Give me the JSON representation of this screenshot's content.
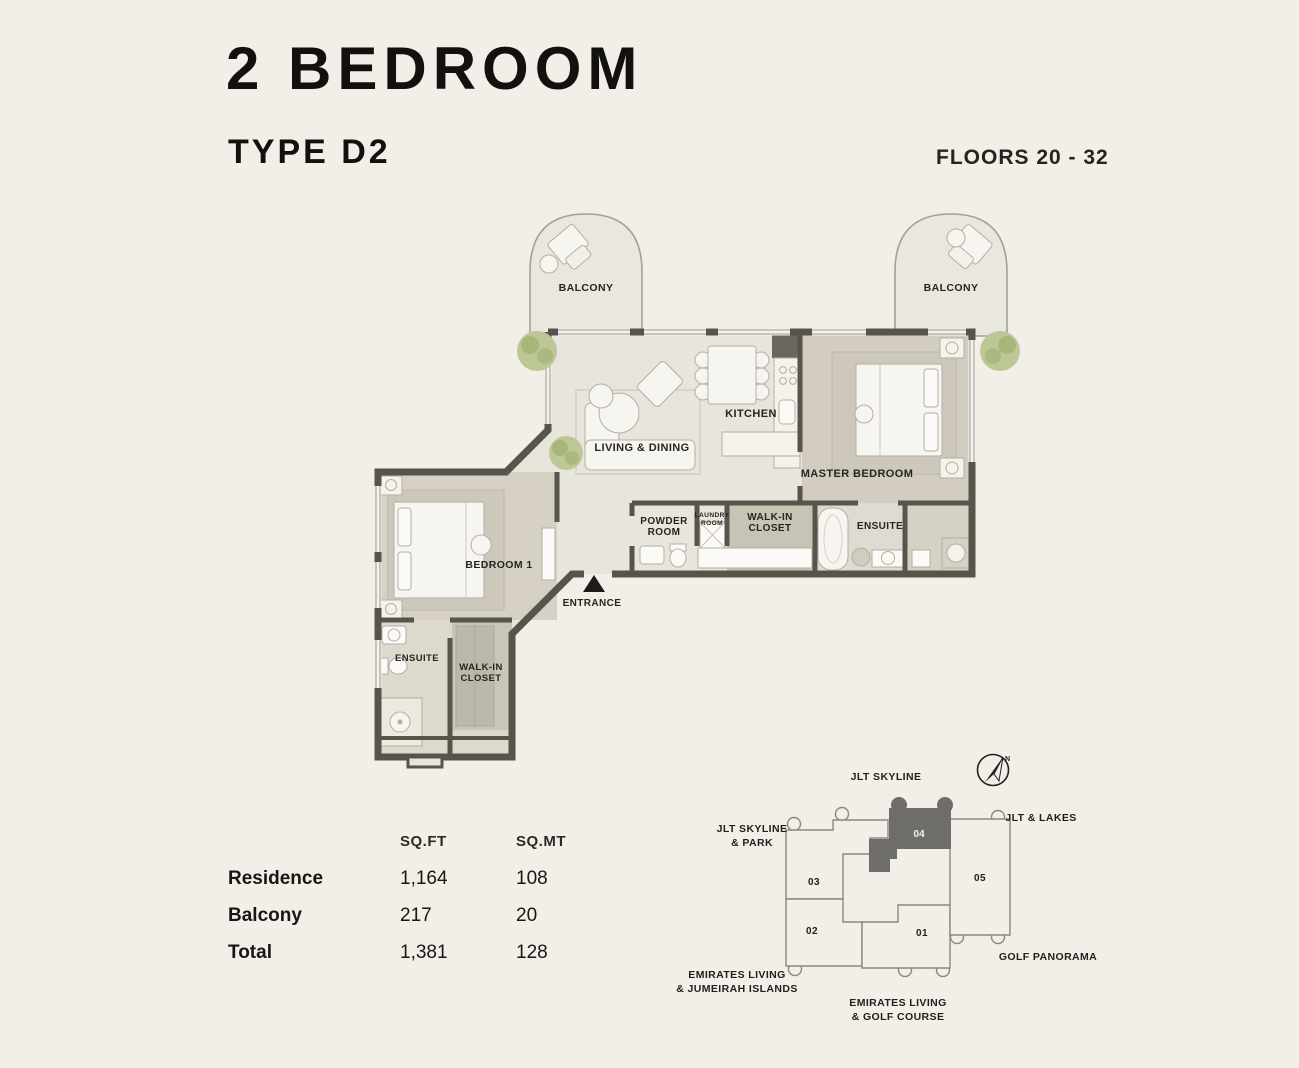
{
  "header": {
    "title": "2 BEDROOM",
    "type": "TYPE D2",
    "floors": "FLOORS 20 - 32"
  },
  "floor_plan": {
    "balcony_left": "BALCONY",
    "balcony_right": "BALCONY",
    "living_dining": "LIVING & DINING",
    "kitchen": "KITCHEN",
    "master_bedroom": "MASTER BEDROOM",
    "powder_room": {
      "line1": "POWDER",
      "line2": "ROOM"
    },
    "laundry_room": {
      "line1": "LAUNDRY",
      "line2": "ROOM"
    },
    "master_walk_in_closet": {
      "line1": "WALK-IN",
      "line2": "CLOSET"
    },
    "master_ensuite": "ENSUITE",
    "bedroom1": "BEDROOM 1",
    "entrance": "ENTRANCE",
    "bedroom1_ensuite": "ENSUITE",
    "bedroom1_walk_in_closet": {
      "line1": "WALK-IN",
      "line2": "CLOSET"
    }
  },
  "area_table": {
    "col_sqft": "SQ.FT",
    "col_sqmt": "SQ.MT",
    "rows": [
      {
        "label": "Residence",
        "sqft": "1,164",
        "sqmt": "108"
      },
      {
        "label": "Balcony",
        "sqft": "217",
        "sqmt": "20"
      },
      {
        "label": "Total",
        "sqft": "1,381",
        "sqmt": "128"
      }
    ]
  },
  "site_plan": {
    "jlt_skyline": "JLT SKYLINE",
    "jlt_skyline_park": {
      "line1": "JLT SKYLINE",
      "line2": "& PARK"
    },
    "jlt_lakes": "JLT & LAKES",
    "golf_panorama": "GOLF PANORAMA",
    "emirates_living_jumeirah": {
      "line1": "EMIRATES LIVING",
      "line2": "& JUMEIRAH ISLANDS"
    },
    "emirates_living_golf": {
      "line1": "EMIRATES LIVING",
      "line2": "& GOLF COURSE"
    },
    "units": {
      "u01": "01",
      "u02": "02",
      "u03": "03",
      "u04": "04",
      "u05": "05"
    },
    "highlighted_unit": "04",
    "compass_n": "N"
  },
  "colors": {
    "background": "#f2efe9",
    "wall": "#57544c",
    "floor_light": "#e8e5dd",
    "floor_beige": "#d3cec1",
    "closet": "#c7c3b5",
    "balcony": "#eae7df",
    "plant": "#b8c48e",
    "highlighted_unit_fill": "#6f6d69",
    "text": "#22211d"
  }
}
